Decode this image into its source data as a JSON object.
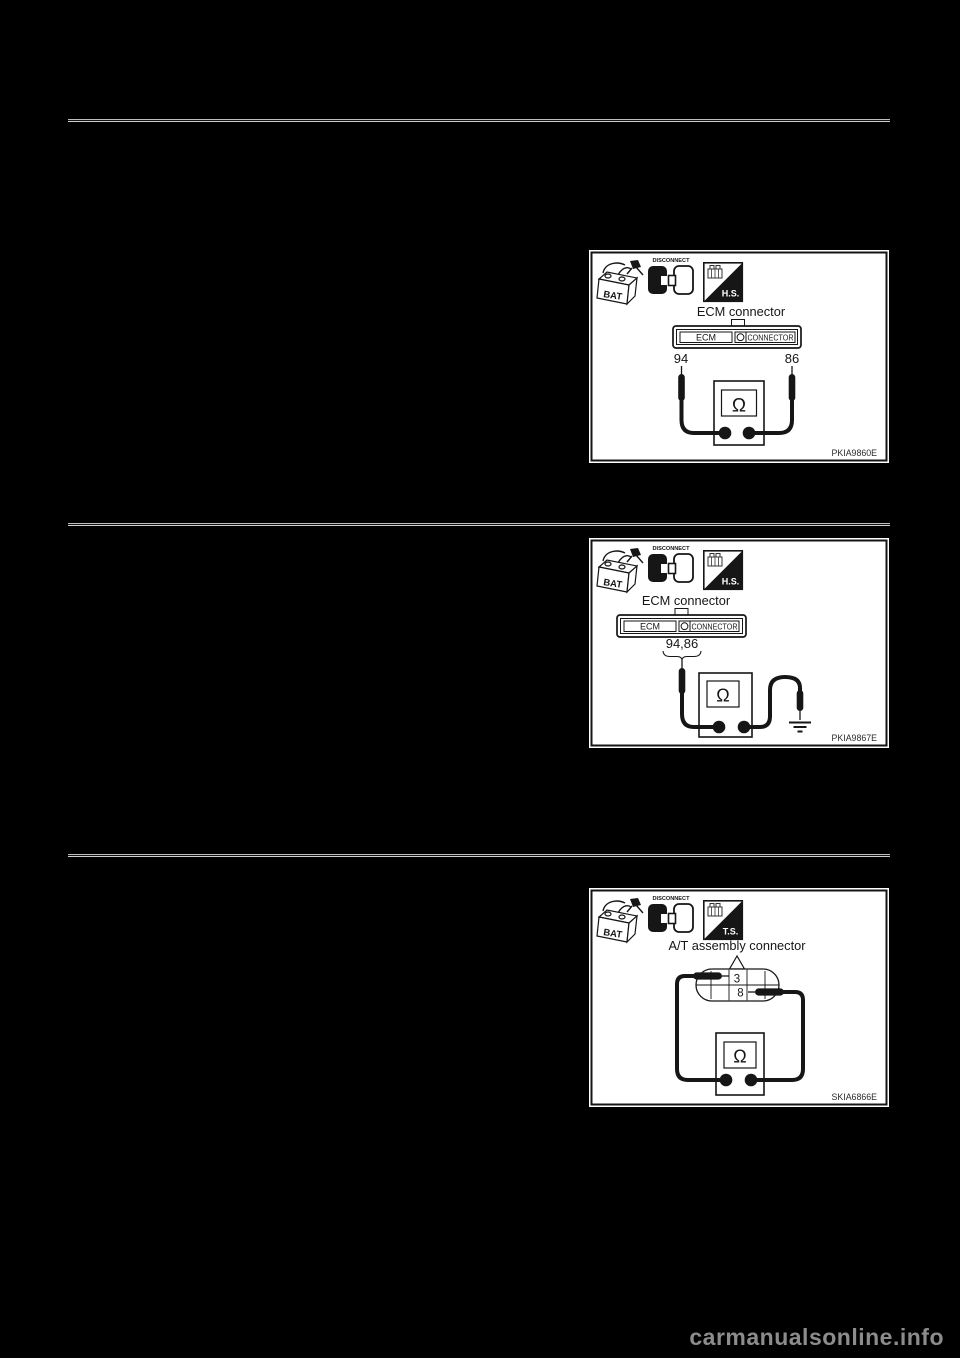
{
  "page": {
    "background_color": "#000000",
    "watermark": "carmanualsonline.info",
    "watermark_color": "#8c8c8c"
  },
  "figures": [
    {
      "battery_label": "BAT",
      "disconnect_label": "DISCONNECT",
      "probe_tool_label": "H.S.",
      "title": "ECM connector",
      "connector_left_label": "ECM",
      "connector_right_label": "CONNECTOR",
      "terminal_left": "94",
      "terminal_right": "86",
      "meter_symbol": "Ω",
      "figure_code": "PKIA9860E"
    },
    {
      "battery_label": "BAT",
      "disconnect_label": "DISCONNECT",
      "probe_tool_label": "H.S.",
      "title": "ECM connector",
      "connector_left_label": "ECM",
      "connector_right_label": "CONNECTOR",
      "terminals_label": "94,86",
      "meter_symbol": "Ω",
      "figure_code": "PKIA9867E"
    },
    {
      "battery_label": "BAT",
      "disconnect_label": "DISCONNECT",
      "probe_tool_label": "T.S.",
      "title": "A/T assembly connector",
      "terminal_top": "3",
      "terminal_bottom": "8",
      "meter_symbol": "Ω",
      "figure_code": "SKIA6866E"
    }
  ]
}
